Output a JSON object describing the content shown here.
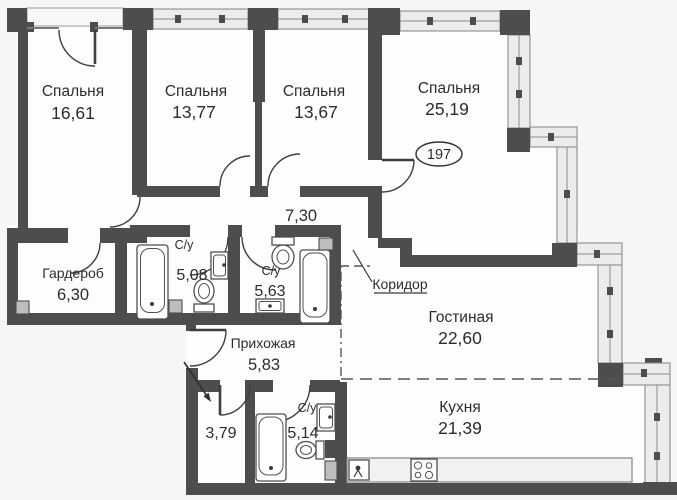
{
  "plan": {
    "unit_number": "197",
    "rooms": {
      "bedroom1": {
        "name": "Спальня",
        "area": "16,61"
      },
      "bedroom2": {
        "name": "Спальня",
        "area": "13,77"
      },
      "bedroom3": {
        "name": "Спальня",
        "area": "13,67"
      },
      "bedroom4": {
        "name": "Спальня",
        "area": "25,19"
      },
      "corridor_top": {
        "area": "7,30"
      },
      "wardrobe": {
        "name": "Гардероб",
        "area": "6,30"
      },
      "bath_a": {
        "name": "С/у",
        "area": "5,08"
      },
      "bath_b": {
        "name": "С/у",
        "area": "5,63"
      },
      "corridor": {
        "name": "Коридор"
      },
      "living": {
        "name": "Гостиная",
        "area": "22,60"
      },
      "hallway": {
        "name": "Прихожая",
        "area": "5,83"
      },
      "storage": {
        "area": "3,79"
      },
      "bath_c": {
        "name": "С/у",
        "area": "5,14"
      },
      "kitchen": {
        "name": "Кухня",
        "area": "21,39"
      }
    },
    "colors": {
      "wall": "#4d4d4d",
      "window_fill": "#ececec",
      "window_frame": "#828282",
      "floor": "#fdfdfd",
      "background": "#f6f6f6",
      "text": "#2d2d2d"
    }
  }
}
